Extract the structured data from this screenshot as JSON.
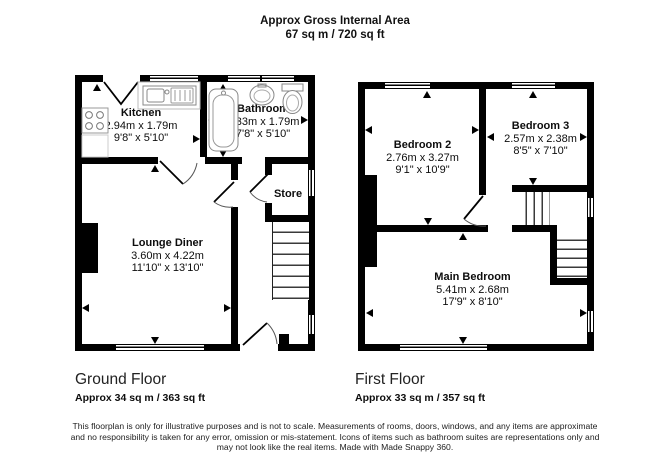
{
  "header": {
    "line1": "Approx Gross Internal Area",
    "line2": "67 sq m / 720 sq ft"
  },
  "ground_floor": {
    "title": "Ground Floor",
    "area": "Approx 34 sq m / 363 sq ft",
    "rooms": {
      "kitchen": {
        "name": "Kitchen",
        "metric": "2.94m x 1.79m",
        "imperial": "9'8\" x 5'10\""
      },
      "bathroom": {
        "name": "Bathroom",
        "metric": "2.33m x 1.79m",
        "imperial": "7'8\" x 5'10\""
      },
      "store": {
        "name": "Store"
      },
      "lounge_diner": {
        "name": "Lounge Diner",
        "metric": "3.60m x 4.22m",
        "imperial": "11'10\" x 13'10\""
      }
    }
  },
  "first_floor": {
    "title": "First Floor",
    "area": "Approx 33 sq m / 357 sq ft",
    "rooms": {
      "bedroom2": {
        "name": "Bedroom 2",
        "metric": "2.76m x 3.27m",
        "imperial": "9'1\" x 10'9\""
      },
      "bedroom3": {
        "name": "Bedroom 3",
        "metric": "2.57m x 2.38m",
        "imperial": "8'5\" x 7'10\""
      },
      "main_bedroom": {
        "name": "Main Bedroom",
        "metric": "5.41m x 2.68m",
        "imperial": "17'9\" x 8'10\""
      }
    }
  },
  "footer": {
    "line1": "This floorplan is only for illustrative purposes and is not to scale. Measurements of rooms, doors, windows, and any items are approximate",
    "line2": "and no responsibility is taken for any error, omission or mis-statement. Icons of items such as bathroom suites are representations only and",
    "line3": "may not look like the real items. Made with Made Snappy 360."
  },
  "colors": {
    "walls": "#000000",
    "background": "#ffffff",
    "fixtures": "#888888"
  }
}
